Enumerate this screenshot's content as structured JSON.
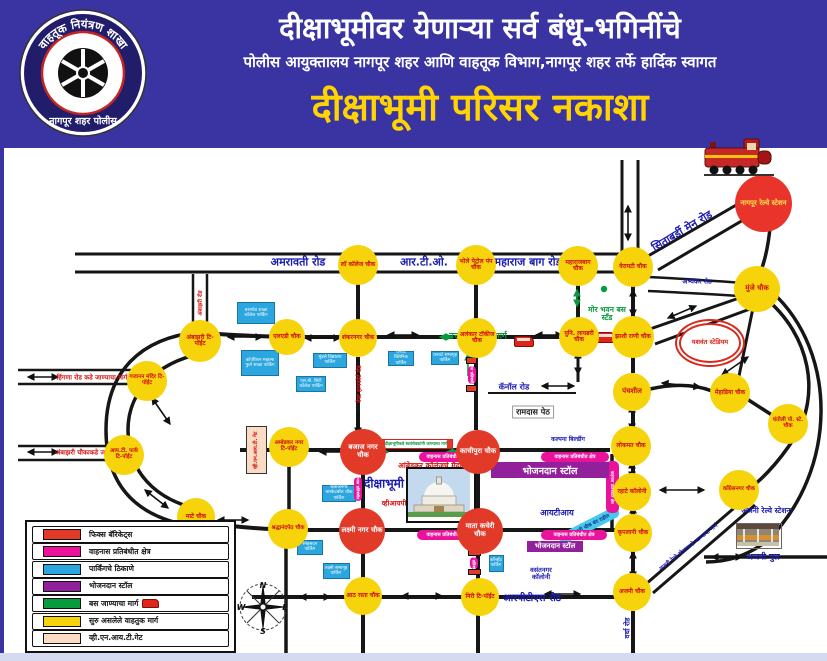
{
  "header": {
    "line1": "दीक्षाभूमीवर येणाऱ्या सर्व बंधू-भगिनींचे",
    "line2": "पोलीस आयुक्तालय नागपूर शहर आणि वाहतूक विभाग,नागपूर शहर तर्फे हार्दिक स्वागत",
    "line3": "दीक्षाभूमी परिसर नकाशा",
    "logo_top": "वाहतूक नियंत्रण शाखा",
    "logo_bottom": "नागपूर शहर पोलीस",
    "bg_color": "#3a33a2",
    "title_color": "#ffd400"
  },
  "legend": {
    "items": [
      {
        "id": "fixed-barricades",
        "color": "#e23a28",
        "label": "फिक्स बॅरिकेट्स"
      },
      {
        "id": "restricted-area",
        "color": "#ea119b",
        "label": "वाहनास प्रतिबंधीत क्षेत्र"
      },
      {
        "id": "parking-places",
        "color": "#2ba6de",
        "label": "पार्किंगचे ठिकाणे"
      },
      {
        "id": "food-stall",
        "color": "#93209b",
        "label": "भोजनदान स्टॉल"
      },
      {
        "id": "bus-route",
        "color": "#089b3e",
        "label": "बस जाण्याचा मार्ग",
        "icon": "bus-icon"
      },
      {
        "id": "open-traffic-route",
        "color": "#f6d30a",
        "label": "सुरु असलेले वाहतुक मार्ग"
      },
      {
        "id": "vnit-gate",
        "color": "#f9dcc3",
        "label": "व्ही.एन.आय.टी.गेट"
      }
    ]
  },
  "map": {
    "yellow_chowks": [
      {
        "id": "law-college-chowk",
        "label": "लॉ कॉलेज चौक",
        "x": 358,
        "y": 265,
        "d": 40
      },
      {
        "id": "bhole-petrol-pump-chowk",
        "label": "भोले पेट्रोल पंप चौक",
        "x": 476,
        "y": 265,
        "d": 40
      },
      {
        "id": "maharajbag-chowk",
        "label": "महाराजबाग चौक",
        "x": 578,
        "y": 266,
        "d": 40
      },
      {
        "id": "variety-chowk",
        "label": "वेरायटी चौक",
        "x": 633,
        "y": 267,
        "d": 40
      },
      {
        "id": "munje-chowk",
        "label": "मुंजे चौक",
        "x": 757,
        "y": 289,
        "d": 46,
        "fs": 7
      },
      {
        "id": "lad-chowk",
        "label": "एलएडी चौक",
        "x": 287,
        "y": 337,
        "d": 36
      },
      {
        "id": "shankarnagar-chowk",
        "label": "शंकरनगर चौक",
        "x": 358,
        "y": 338,
        "d": 38
      },
      {
        "id": "alankar-talkies-chowk",
        "label": "अलंकार टॉकीज चौक",
        "x": 477,
        "y": 338,
        "d": 40
      },
      {
        "id": "uni-library-chowk",
        "label": "युनि. लायब्ररी चौक",
        "x": 579,
        "y": 337,
        "d": 40
      },
      {
        "id": "jhashi-rani-chowk",
        "label": "झाशी राणी चौक",
        "x": 633,
        "y": 337,
        "d": 42
      },
      {
        "id": "ambazari-t-point",
        "label": "अंबाझरी टि-पॉईंट",
        "x": 200,
        "y": 341,
        "d": 42
      },
      {
        "id": "gajanan-mandir-t-point",
        "label": "गजानन मंदिर टि-पॉईंट",
        "x": 147,
        "y": 381,
        "d": 40,
        "fs": 5.5
      },
      {
        "id": "it-park-t-point",
        "label": "आय.टी. पार्क टि-पॉईंट",
        "x": 124,
        "y": 455,
        "d": 40,
        "fs": 5.5
      },
      {
        "id": "mate-chowk",
        "label": "माटे चौक",
        "x": 196,
        "y": 517,
        "d": 38
      },
      {
        "id": "shraddhanandpeth-chowk",
        "label": "श्रद्धानंदपेठ चौक",
        "x": 288,
        "y": 529,
        "d": 40,
        "fs": 5.5
      },
      {
        "id": "ambedkar-nagar-t-point",
        "label": "अम्बेडकर नगर टि-पॉईंट",
        "x": 289,
        "y": 447,
        "d": 40,
        "fs": 5.5
      },
      {
        "id": "panchsheel-chowk",
        "label": "पंचशील",
        "x": 632,
        "y": 392,
        "d": 38,
        "fs": 7
      },
      {
        "id": "mehadia-chowk",
        "label": "मेहाडिया चौक",
        "x": 730,
        "y": 393,
        "d": 40
      },
      {
        "id": "dhantoli-police-station-chowk",
        "label": "धंतोली पो. स्टे. चौक",
        "x": 788,
        "y": 424,
        "d": 40,
        "fs": 5.5
      },
      {
        "id": "lokmat-chowk",
        "label": "लोकमत चौक",
        "x": 631,
        "y": 446,
        "d": 40
      },
      {
        "id": "rahate-colony-chowk",
        "label": "रहाटे कॉलोनी",
        "x": 632,
        "y": 492,
        "d": 38
      },
      {
        "id": "congressnagar-chowk",
        "label": "कॉंग्रेसनगर चौक",
        "x": 739,
        "y": 490,
        "d": 40,
        "fs": 5.5
      },
      {
        "id": "kripalani-chowk",
        "label": "कृपलानी चौक",
        "x": 633,
        "y": 533,
        "d": 38
      },
      {
        "id": "ajni-chowk",
        "label": "अजनी चौक",
        "x": 632,
        "y": 592,
        "d": 38
      },
      {
        "id": "aath-rasta-chowk",
        "label": "आठ रस्ता चौक",
        "x": 363,
        "y": 596,
        "d": 38
      },
      {
        "id": "neeri-t-point",
        "label": "निरी टि-पॉईंट",
        "x": 480,
        "y": 597,
        "d": 38
      }
    ],
    "red_chowks": [
      {
        "id": "bajaj-nagar-chowk",
        "label": "बजाज नगर चौक",
        "x": 363,
        "y": 452,
        "d": 46
      },
      {
        "id": "kachipura-chowk",
        "label": "काचीपुरा चौक",
        "x": 478,
        "y": 452,
        "d": 44
      },
      {
        "id": "laxmi-nagar-chowk",
        "label": "लक्ष्मी नगर चौक",
        "x": 362,
        "y": 531,
        "d": 46
      },
      {
        "id": "mata-kacheri-chowk",
        "label": "माता कचेरी चौक",
        "x": 480,
        "y": 531,
        "d": 46
      }
    ],
    "stations": [
      {
        "id": "nagpur-railway-station",
        "label": "नागपूर रेल्वे स्टेशन"
      },
      {
        "id": "yashwant-stadium",
        "label": "यशवंत स्टेडियम"
      }
    ],
    "labels": [
      {
        "id": "amravati-road",
        "text": "अमरावती रोड",
        "x": 298,
        "y": 262,
        "fs": 11,
        "color": "blue"
      },
      {
        "id": "rto-label",
        "text": "आर.टी.ओ.",
        "x": 424,
        "y": 262,
        "fs": 11,
        "color": "blue"
      },
      {
        "id": "maharaj-bag-road",
        "text": "महाराज बाग रोड",
        "x": 528,
        "y": 262,
        "fs": 11,
        "color": "blue"
      },
      {
        "id": "abhyankar-road",
        "text": "अभ्यंकर रोड",
        "x": 697,
        "y": 281,
        "fs": 6.5,
        "color": "blue"
      },
      {
        "id": "sitabardi-main-road",
        "text": "सिताबर्डी मेन रोड",
        "x": 682,
        "y": 231,
        "fs": 11,
        "color": "blue",
        "rot": -31
      },
      {
        "id": "canal-road",
        "text": "कॅनॉल रोड",
        "x": 514,
        "y": 387,
        "fs": 8,
        "color": "blue"
      },
      {
        "id": "ramdas-peth",
        "text": "रामदास पेठ",
        "x": 533,
        "y": 412,
        "fs": 8,
        "color": "dark",
        "box": true
      },
      {
        "id": "kalpana-building",
        "text": "कल्पना बिल्डींग",
        "x": 568,
        "y": 439,
        "fs": 6,
        "color": "blue"
      },
      {
        "id": "iti-label",
        "text": "आयटीआय",
        "x": 557,
        "y": 513,
        "fs": 8.5,
        "color": "blue"
      },
      {
        "id": "vasantnagar-colony",
        "text": "वसंतनगर कॉलोनी",
        "x": 541,
        "y": 574,
        "fs": 6.5,
        "color": "blue",
        "w": 36
      },
      {
        "id": "rpts-road",
        "text": "आरपीटीएस रोड",
        "x": 532,
        "y": 597,
        "fs": 10,
        "color": "blue"
      },
      {
        "id": "wardha-road",
        "text": "वर्धा रोड",
        "x": 628,
        "y": 628,
        "fs": 7,
        "color": "blue",
        "rot": -90
      },
      {
        "id": "ajni-pul",
        "text": "अजनी पुल",
        "x": 763,
        "y": 557,
        "fs": 8.5,
        "color": "blue"
      },
      {
        "id": "ajni-railway-station",
        "text": "अजनी रेल्वे स्टेशन",
        "x": 766,
        "y": 511,
        "fs": 7.5,
        "color": "blue",
        "w": 54
      },
      {
        "id": "ajni-station-way",
        "text": "अजनी रेल्वे स्टेशनकडे जाण्याचा मार्ग",
        "x": 688,
        "y": 547,
        "fs": 5.5,
        "color": "blue",
        "rot": -38
      },
      {
        "id": "uttar-ambazari-marg",
        "text": "उत्तर अंबाझरी मार्ग",
        "x": 478,
        "y": 336,
        "fs": 8.5,
        "color": "green"
      },
      {
        "id": "mor-bhavan-bus-stand",
        "text": "मोर भवन बस स्टँड",
        "x": 607,
        "y": 314,
        "fs": 7.5,
        "color": "green",
        "w": 48
      },
      {
        "id": "hingna-road-way",
        "text": "हिंगणा रोड कडे जाण्याचा मार्ग",
        "x": 92,
        "y": 377,
        "fs": 6.5,
        "color": "red"
      },
      {
        "id": "ambazari-chowk-way",
        "text": "अंबाझरी चौकाकडे जाण्याचा मार्ग",
        "x": 94,
        "y": 452,
        "fs": 6.5,
        "color": "red"
      },
      {
        "id": "ambedkar-college-ground",
        "text": "आंबेडकर कॉलेजचे मैदान",
        "x": 432,
        "y": 466,
        "fs": 7.5,
        "color": "red"
      },
      {
        "id": "deekshabhoomi-label",
        "text": "दीक्षाभूमी",
        "x": 384,
        "y": 483,
        "fs": 12,
        "color": "blue"
      },
      {
        "id": "vip-gate",
        "text": "व्हीआयपी गेट",
        "x": 399,
        "y": 504,
        "fs": 7,
        "color": "red"
      },
      {
        "id": "west-highcourt-road",
        "text": "वेस्ट हायकोर्ट रोड",
        "x": 359,
        "y": 384,
        "fs": 6,
        "color": "red",
        "rot": -90
      },
      {
        "id": "ambazari-road",
        "text": "अंबाझरी रोड",
        "x": 200,
        "y": 303,
        "fs": 5.5,
        "color": "red",
        "rot": -90
      }
    ],
    "parkings": [
      {
        "id": "parking-dharampeth",
        "text": "धरमपेठ शाळा कॉलेज पार्किंग",
        "x": 256,
        "y": 313,
        "w": 38,
        "h": 22
      },
      {
        "id": "parking-corporation",
        "text": "कॉर्पोरेशन महात्मा फुले शाळा पार्किंग",
        "x": 260,
        "y": 363,
        "w": 38,
        "h": 26
      },
      {
        "id": "parking-sb-city",
        "text": "एस.बी. सिटी कॉलेज पार्किंग",
        "x": 311,
        "y": 384,
        "w": 30,
        "h": 16
      },
      {
        "id": "parking-mundle",
        "text": "मुंडले विद्यालय पार्किंग",
        "x": 330,
        "y": 360,
        "w": 34,
        "h": 15
      },
      {
        "id": "parking-dhanwate-clinic",
        "text": "धनवटे क्लिनिक पार्किंग",
        "x": 401,
        "y": 358,
        "w": 26,
        "h": 15
      },
      {
        "id": "parking-dhanwate-hall",
        "text": "धनवटे सभागृह पार्किंग",
        "x": 445,
        "y": 358,
        "w": 28,
        "h": 14
      },
      {
        "id": "parking-bajajnagar",
        "text": "बजाजनगर बास्केटबॉल चौक पार्किंग",
        "x": 339,
        "y": 493,
        "w": 34,
        "h": 17
      },
      {
        "id": "parking-snehsadan",
        "text": "स्नेहसदन पार्किंग",
        "x": 310,
        "y": 547,
        "w": 26,
        "h": 15
      },
      {
        "id": "parking-laxmi-hall",
        "text": "लक्ष्मी सभागृह पार्किंग",
        "x": 336,
        "y": 571,
        "w": 27,
        "h": 16
      },
      {
        "id": "parking-convent",
        "text": "कॉन्व्हेंट पार्किंग",
        "x": 496,
        "y": 563,
        "w": 15,
        "h": 17
      }
    ],
    "restricted_strips": [
      {
        "id": "restricted-1",
        "text": "वाहनास प्रतिबंधीत क्षेत्र",
        "x": 419,
        "y": 452,
        "w": 56,
        "h": 10
      },
      {
        "id": "restricted-2",
        "text": "वाहनास प्रतिबंधीत क्षेत्र",
        "x": 541,
        "y": 452,
        "w": 68,
        "h": 10
      },
      {
        "id": "restricted-3",
        "text": "वाहनास प्रतिबंधीत क्षेत्र",
        "x": 417,
        "y": 530,
        "w": 60,
        "h": 10
      },
      {
        "id": "restricted-4",
        "text": "वाहनास प्रतिबंधीत क्षेत्र",
        "x": 541,
        "y": 530,
        "w": 66,
        "h": 10
      },
      {
        "id": "restricted-5",
        "text": "वाहनास प्रतिबंधीत क्षेत्र",
        "x": 354,
        "y": 477,
        "w": 8,
        "h": 24,
        "vert": true
      },
      {
        "id": "restricted-6",
        "text": "वाहनास प्रतिबंधीत क्षेत्र",
        "x": 470,
        "y": 557,
        "w": 8,
        "h": 12,
        "vert": true
      },
      {
        "id": "restricted-7",
        "text": "वाहनास प्रतिबंधीत क्षेत्र",
        "x": 468,
        "y": 366,
        "w": 8,
        "h": 18,
        "vert": true
      },
      {
        "id": "restricted-8",
        "text": "वाहनास प्रतिबंधीत क्षेत्र",
        "x": 606,
        "y": 461,
        "w": 13,
        "h": 52,
        "vert": true
      }
    ],
    "food_stalls": [
      {
        "id": "food-stall-1",
        "text": "भोजनदान स्टॉल",
        "x": 491,
        "y": 462,
        "w": 118,
        "h": 16,
        "fs": 9.5
      },
      {
        "id": "food-stall-2",
        "text": "भोजनदान स्टॉल",
        "x": 527,
        "y": 541,
        "w": 56,
        "h": 11,
        "fs": 7
      }
    ],
    "barricades": [
      {
        "x": 466,
        "y": 357,
        "w": 11,
        "h": 7
      },
      {
        "x": 466,
        "y": 385,
        "w": 11,
        "h": 7
      },
      {
        "x": 300,
        "y": 445,
        "w": 6,
        "h": 12
      },
      {
        "x": 345,
        "y": 538,
        "w": 11,
        "h": 6
      },
      {
        "x": 468,
        "y": 550,
        "w": 13,
        "h": 6
      },
      {
        "x": 468,
        "y": 569,
        "w": 13,
        "h": 6
      }
    ],
    "buses": [
      {
        "x": 514,
        "y": 336
      },
      {
        "x": 596,
        "y": 332
      }
    ],
    "vnit_gate": {
      "label": "व्ही.एन.आय.टी. गेट"
    },
    "volunteer_strip": {
      "text": "दीक्षाभूमीकडे स्वयंसेवकांनी जाण्याचा मार्ग"
    },
    "closed_band": {
      "text": "कृपलानी चौक बंद राहील"
    },
    "compass": {
      "n": "N",
      "e": "E",
      "s": "S",
      "w": "W"
    }
  }
}
